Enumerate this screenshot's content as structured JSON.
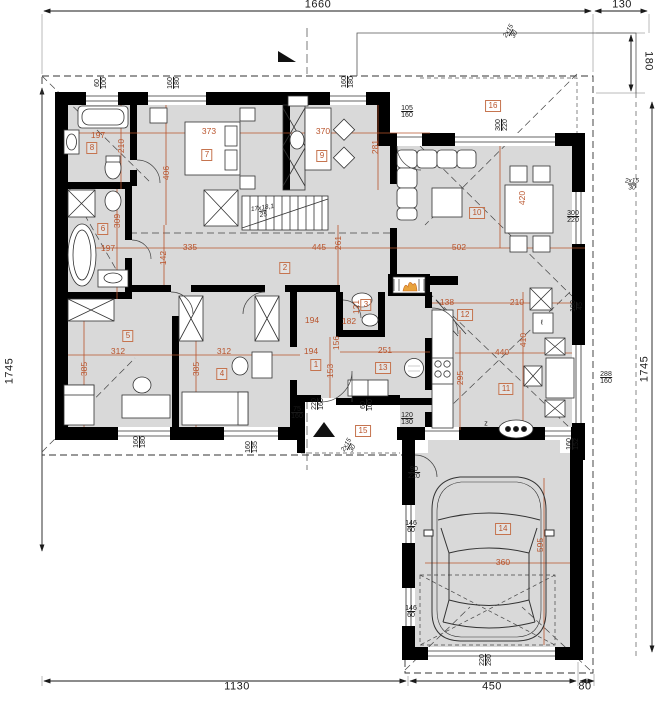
{
  "canvas": {
    "width": 660,
    "height": 701,
    "background": "#ffffff"
  },
  "colors": {
    "wall": "#000000",
    "floor": "#d9d9d9",
    "dimension_accent": "#b9542c",
    "line": "#1a1a1a"
  },
  "border_dimensions": [
    {
      "id": "top-width",
      "text": "1660",
      "x": 318,
      "y": 5,
      "rot": 0
    },
    {
      "id": "top-terrace-width",
      "text": "130",
      "x": 622,
      "y": 5,
      "rot": 0
    },
    {
      "id": "right-terrace-depth",
      "text": "180",
      "x": 648,
      "y": 61,
      "rot": 90
    },
    {
      "id": "left-height",
      "text": "1745",
      "x": 10,
      "y": 371,
      "rot": -90
    },
    {
      "id": "right-height",
      "text": "1745",
      "x": 645,
      "y": 369,
      "rot": -90
    },
    {
      "id": "bottom-left-width",
      "text": "1130",
      "x": 237,
      "y": 687,
      "rot": 0
    },
    {
      "id": "bottom-garage-width",
      "text": "450",
      "x": 492,
      "y": 687,
      "rot": 0
    },
    {
      "id": "bottom-right-offset",
      "text": "80",
      "x": 585,
      "y": 687,
      "rot": 0
    }
  ],
  "room_labels": [
    {
      "number": "1",
      "x": 316,
      "y": 365
    },
    {
      "number": "2",
      "x": 285,
      "y": 268
    },
    {
      "number": "3",
      "x": 366,
      "y": 305
    },
    {
      "number": "4",
      "x": 222,
      "y": 374
    },
    {
      "number": "5",
      "x": 128,
      "y": 336
    },
    {
      "number": "6",
      "x": 103,
      "y": 229
    },
    {
      "number": "7",
      "x": 207,
      "y": 155
    },
    {
      "number": "8",
      "x": 92,
      "y": 148
    },
    {
      "number": "9",
      "x": 322,
      "y": 156
    },
    {
      "number": "10",
      "x": 477,
      "y": 213
    },
    {
      "number": "11",
      "x": 506,
      "y": 389
    },
    {
      "number": "12",
      "x": 465,
      "y": 315
    },
    {
      "number": "13",
      "x": 383,
      "y": 368
    },
    {
      "number": "14",
      "x": 503,
      "y": 529
    },
    {
      "number": "15",
      "x": 363,
      "y": 431
    },
    {
      "number": "16",
      "x": 493,
      "y": 106
    }
  ],
  "dimensions": [
    {
      "text": "197",
      "x": 98,
      "y": 135,
      "rot": 0
    },
    {
      "text": "373",
      "x": 209,
      "y": 131,
      "rot": 0
    },
    {
      "text": "370",
      "x": 323,
      "y": 131,
      "rot": 0
    },
    {
      "text": "210",
      "x": 121,
      "y": 146,
      "rot": -90
    },
    {
      "text": "406",
      "x": 166,
      "y": 173,
      "rot": -90
    },
    {
      "text": "281",
      "x": 375,
      "y": 147,
      "rot": -90
    },
    {
      "text": "309",
      "x": 117,
      "y": 221,
      "rot": -90
    },
    {
      "text": "197",
      "x": 108,
      "y": 248,
      "rot": 0
    },
    {
      "text": "142",
      "x": 163,
      "y": 258,
      "rot": -90
    },
    {
      "text": "335",
      "x": 190,
      "y": 247,
      "rot": 0
    },
    {
      "text": "445",
      "x": 319,
      "y": 247,
      "rot": 0
    },
    {
      "text": "502",
      "x": 459,
      "y": 247,
      "rot": 0
    },
    {
      "text": "261",
      "x": 338,
      "y": 243,
      "rot": -90
    },
    {
      "text": "312",
      "x": 118,
      "y": 351,
      "rot": 0
    },
    {
      "text": "385",
      "x": 84,
      "y": 369,
      "rot": -90
    },
    {
      "text": "312",
      "x": 224,
      "y": 351,
      "rot": 0
    },
    {
      "text": "385",
      "x": 196,
      "y": 369,
      "rot": -90
    },
    {
      "text": "121",
      "x": 356,
      "y": 307,
      "rot": -90
    },
    {
      "text": "182",
      "x": 349,
      "y": 321,
      "rot": 0
    },
    {
      "text": "194",
      "x": 312,
      "y": 320,
      "rot": 0
    },
    {
      "text": "194",
      "x": 311,
      "y": 351,
      "rot": 0
    },
    {
      "text": "153",
      "x": 330,
      "y": 371,
      "rot": -90
    },
    {
      "text": "156",
      "x": 336,
      "y": 343,
      "rot": -90
    },
    {
      "text": "251",
      "x": 385,
      "y": 350,
      "rot": 0
    },
    {
      "text": "138",
      "x": 447,
      "y": 302,
      "rot": 0
    },
    {
      "text": "210",
      "x": 517,
      "y": 302,
      "rot": 0
    },
    {
      "text": "440",
      "x": 502,
      "y": 352,
      "rot": 0
    },
    {
      "text": "410",
      "x": 523,
      "y": 340,
      "rot": -90
    },
    {
      "text": "295",
      "x": 460,
      "y": 378,
      "rot": -90
    },
    {
      "text": "420",
      "x": 522,
      "y": 198,
      "rot": -90
    },
    {
      "text": "360",
      "x": 503,
      "y": 562,
      "rot": 0
    },
    {
      "text": "595",
      "x": 540,
      "y": 545,
      "rot": -90
    }
  ],
  "paired_dimensions": [
    {
      "top": "60",
      "bottom": "100",
      "x": 101,
      "y": 83,
      "rot": -90,
      "italic": false
    },
    {
      "top": "160",
      "bottom": "180",
      "x": 174,
      "y": 83,
      "rot": -90,
      "italic": false
    },
    {
      "top": "160",
      "bottom": "180",
      "x": 348,
      "y": 82,
      "rot": -90,
      "italic": false
    },
    {
      "top": "105",
      "bottom": "160",
      "x": 407,
      "y": 112,
      "rot": 0,
      "italic": false
    },
    {
      "top": "300",
      "bottom": "220",
      "x": 502,
      "y": 125,
      "rot": -90,
      "italic": false
    },
    {
      "top": "300",
      "bottom": "220",
      "x": 573,
      "y": 217,
      "rot": 0,
      "italic": false
    },
    {
      "top": "288",
      "bottom": "160",
      "x": 606,
      "y": 378,
      "rot": 0,
      "italic": false
    },
    {
      "top": "180",
      "bottom": "45",
      "x": 577,
      "y": 306,
      "rot": -90,
      "italic": false
    },
    {
      "top": "160",
      "bottom": "152",
      "x": 573,
      "y": 444,
      "rot": -90,
      "italic": false
    },
    {
      "top": "120",
      "bottom": "130",
      "x": 407,
      "y": 419,
      "rot": 0,
      "italic": false
    },
    {
      "top": "90",
      "bottom": "220",
      "x": 414,
      "y": 473,
      "rot": 0,
      "italic": false
    },
    {
      "top": "146",
      "bottom": "60",
      "x": 411,
      "y": 527,
      "rot": 0,
      "italic": false
    },
    {
      "top": "146",
      "bottom": "60",
      "x": 411,
      "y": 612,
      "rot": 0,
      "italic": false
    },
    {
      "top": "220",
      "bottom": "280",
      "x": 486,
      "y": 660,
      "rot": -90,
      "italic": false
    },
    {
      "top": "60",
      "bottom": "100",
      "x": 367,
      "y": 405,
      "rot": -90,
      "italic": false
    },
    {
      "top": "160",
      "bottom": "135",
      "x": 252,
      "y": 447,
      "rot": -90,
      "italic": false
    },
    {
      "top": "160",
      "bottom": "180",
      "x": 140,
      "y": 442,
      "rot": -90,
      "italic": false
    },
    {
      "top": "75",
      "bottom": "160",
      "x": 297,
      "y": 413,
      "rot": 0,
      "italic": false
    },
    {
      "top": "220",
      "bottom": "160",
      "x": 318,
      "y": 404,
      "rot": -90,
      "italic": false
    },
    {
      "top": "2x15",
      "bottom": "30",
      "x": 512,
      "y": 33,
      "rot": -60,
      "italic": true
    },
    {
      "top": "2x15",
      "bottom": "30",
      "x": 632,
      "y": 185,
      "rot": 0,
      "italic": true
    },
    {
      "top": "2x15",
      "bottom": "30",
      "x": 350,
      "y": 447,
      "rot": -60,
      "italic": true
    },
    {
      "top": "17x18,1",
      "bottom": "25",
      "x": 263,
      "y": 212,
      "rot": -8,
      "italic": true
    }
  ],
  "annotations": [
    {
      "id": "gas-connection-letter",
      "text": "z",
      "x": 486,
      "y": 424
    },
    {
      "id": "fridge-letter",
      "text": "ℓ",
      "x": 542,
      "y": 323
    }
  ]
}
